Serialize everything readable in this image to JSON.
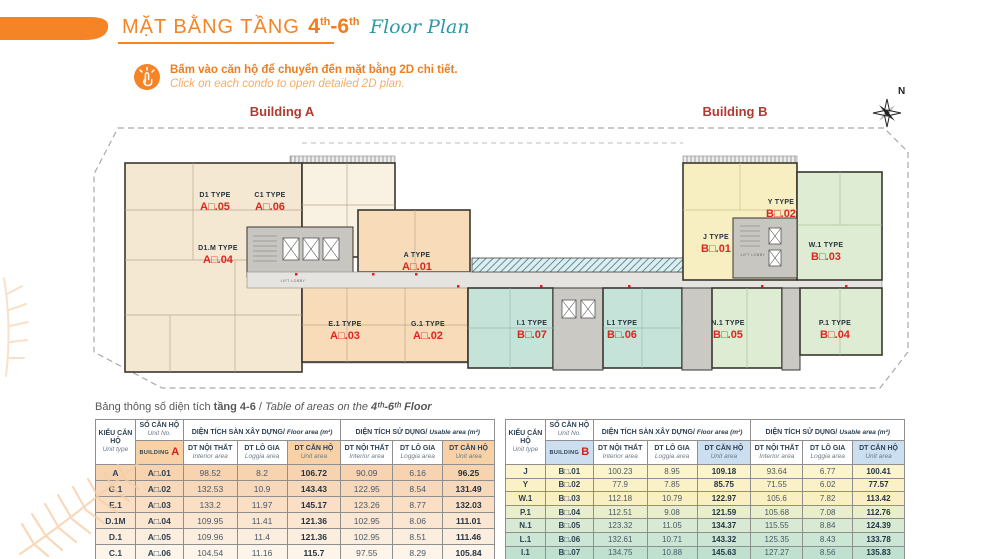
{
  "header": {
    "title_vi": "MẶT BẰNG TẦNG",
    "floor": {
      "n1": "4",
      "s1": "th",
      "dash": "-",
      "n2": "6",
      "s2": "th"
    },
    "title_en": "Floor Plan"
  },
  "instruction": {
    "vi": "Bấm vào căn hộ để chuyển đến mặt bằng 2D chi tiết.",
    "en": "Click on each condo to open detailed 2D plan.",
    "icon": "click-hand-icon"
  },
  "plan": {
    "building_a_label": "Building A",
    "building_b_label": "Building B",
    "compass_n": "N",
    "lift_lobby": "LIFT LOBBY",
    "colors": {
      "cream": "#f4e8d2",
      "cream_light": "#f9f1e1",
      "peach": "#f8dcba",
      "teal": "#c6e3da",
      "green": "#ddecd2",
      "yellow": "#f7eec2",
      "core_gray": "#c8c6c1",
      "corridor": "#e6e4e0",
      "unit_no_red": "#e02420",
      "building_label_red": "#b03a30"
    },
    "units": [
      {
        "type": "D1 TYPE",
        "no": "A□.05",
        "x": 130,
        "y": 100
      },
      {
        "type": "C1 TYPE",
        "no": "A□.06",
        "x": 185,
        "y": 100
      },
      {
        "type": "D1.M TYPE",
        "no": "A□.04",
        "x": 133,
        "y": 153
      },
      {
        "type": "A TYPE",
        "no": "A□.01",
        "x": 332,
        "y": 160
      },
      {
        "type": "E.1 TYPE",
        "no": "A□.03",
        "x": 260,
        "y": 229
      },
      {
        "type": "G.1 TYPE",
        "no": "A□.02",
        "x": 343,
        "y": 229
      },
      {
        "type": "I.1 TYPE",
        "no": "B□.07",
        "x": 447,
        "y": 228
      },
      {
        "type": "L1 TYPE",
        "no": "B□.06",
        "x": 537,
        "y": 228
      },
      {
        "type": "N.1 TYPE",
        "no": "B□.05",
        "x": 643,
        "y": 228
      },
      {
        "type": "J TYPE",
        "no": "B□.01",
        "x": 631,
        "y": 142
      },
      {
        "type": "Y TYPE",
        "no": "B□.02",
        "x": 696,
        "y": 107
      },
      {
        "type": "W.1 TYPE",
        "no": "B□.03",
        "x": 741,
        "y": 150
      },
      {
        "type": "P.1 TYPE",
        "no": "B□.04",
        "x": 750,
        "y": 228
      }
    ]
  },
  "caption": {
    "vi": "Bảng thông số diện tích ",
    "vi_bold": "tầng 4-6",
    "sep": " / ",
    "en": "Table of areas on the ",
    "en_bold": "4ᵗʰ-6ᵗʰ Floor"
  },
  "table_headers": {
    "unit_type_vi": "KIỂU CĂN HỘ",
    "unit_type_en": "Unit type",
    "unit_no_vi": "SỐ CĂN HỘ",
    "unit_no_en": "Unit No.",
    "floor_group_vi": "DIỆN TÍCH SÀN XÂY DỰNG/",
    "floor_group_en": "Floor area (m²)",
    "usable_group_vi": "DIỆN TÍCH SỬ DỤNG/",
    "usable_group_en": "Usable area (m²)",
    "building_word": "BUILDING",
    "sub": [
      {
        "vi": "DT NỘI THẤT",
        "en": "Interior area"
      },
      {
        "vi": "DT LÔ GIA",
        "en": "Loggia area"
      },
      {
        "vi": "DT CĂN HỘ",
        "en": "Unit area"
      }
    ]
  },
  "tables": [
    {
      "id": "a",
      "letter": "A",
      "accent": "#f8d2a6",
      "rows": [
        {
          "type": "A",
          "no": "A□.01",
          "values": [
            "98.52",
            "8.2",
            "106.72",
            "90.09",
            "6.16",
            "96.25"
          ],
          "color": "#f8d3b0"
        },
        {
          "type": "G.1",
          "no": "A□.02",
          "values": [
            "132.53",
            "10.9",
            "143.43",
            "122.95",
            "8.54",
            "131.49"
          ],
          "color": "#f8d8ba"
        },
        {
          "type": "E.1",
          "no": "A□.03",
          "values": [
            "133.2",
            "11.97",
            "145.17",
            "123.26",
            "8.77",
            "132.03"
          ],
          "color": "#fadfc4"
        },
        {
          "type": "D.1M",
          "no": "A□.04",
          "values": [
            "109.95",
            "11.41",
            "121.36",
            "102.95",
            "8.06",
            "111.01"
          ],
          "color": "#fbe6d1"
        },
        {
          "type": "D.1",
          "no": "A□.05",
          "values": [
            "109.96",
            "11.4",
            "121.36",
            "102.95",
            "8.51",
            "111.46"
          ],
          "color": "#fceede"
        },
        {
          "type": "C.1",
          "no": "A□.06",
          "values": [
            "104.54",
            "11.16",
            "115.7",
            "97.55",
            "8.29",
            "105.84"
          ],
          "color": "#fdf4ea"
        }
      ]
    },
    {
      "id": "b",
      "letter": "B",
      "accent": "#ccdff0",
      "rows": [
        {
          "type": "J",
          "no": "B□.01",
          "values": [
            "100.23",
            "8.95",
            "109.18",
            "93.64",
            "6.77",
            "100.41"
          ],
          "color": "#fcf4cf"
        },
        {
          "type": "Y",
          "no": "B□.02",
          "values": [
            "77.9",
            "7.85",
            "85.75",
            "71.55",
            "6.02",
            "77.57"
          ],
          "color": "#fbf1c6"
        },
        {
          "type": "W.1",
          "no": "B□.03",
          "values": [
            "112.18",
            "10.79",
            "122.97",
            "105.6",
            "7.82",
            "113.42"
          ],
          "color": "#f9efc2"
        },
        {
          "type": "P.1",
          "no": "B□.04",
          "values": [
            "112.51",
            "9.08",
            "121.59",
            "105.68",
            "7.08",
            "112.76"
          ],
          "color": "#e9efca"
        },
        {
          "type": "N.1",
          "no": "B□.05",
          "values": [
            "123.32",
            "11.05",
            "134.37",
            "115.55",
            "8.84",
            "124.39"
          ],
          "color": "#d8ead4"
        },
        {
          "type": "L.1",
          "no": "B□.06",
          "values": [
            "132.61",
            "10.71",
            "143.32",
            "125.35",
            "8.43",
            "133.78"
          ],
          "color": "#cce6d5"
        },
        {
          "type": "I.1",
          "no": "B□.07",
          "values": [
            "134.75",
            "10.88",
            "145.63",
            "127.27",
            "8.56",
            "135.83"
          ],
          "color": "#c0e1d0"
        }
      ]
    }
  ]
}
